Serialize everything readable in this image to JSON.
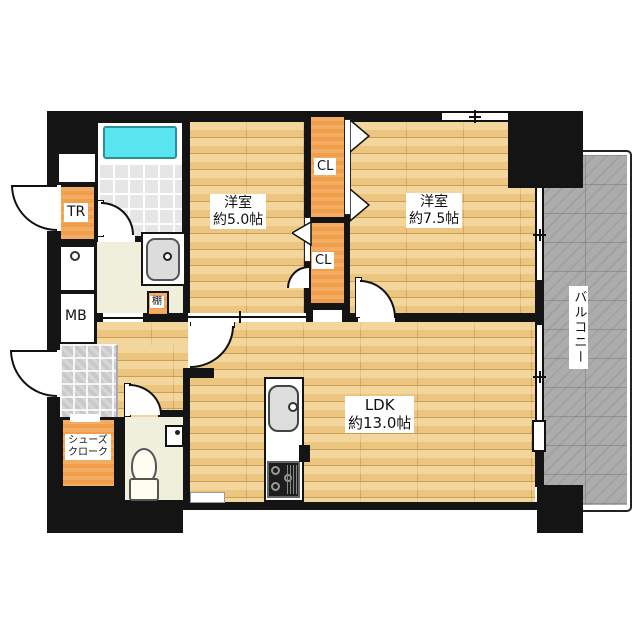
{
  "labels": {
    "bedroom1": {
      "name": "洋室",
      "size": "約5.0帖"
    },
    "bedroom2": {
      "name": "洋室",
      "size": "約7.5帖"
    },
    "ldk": {
      "name": "LDK",
      "size": "約13.0帖"
    },
    "balcony": "バルコニー",
    "closet_upper": "CL",
    "closet_lower": "CL",
    "trunk_room": "TR",
    "meter_box": "MB",
    "shelf": "棚",
    "shoe_closet": {
      "line1": "シューズ",
      "line2": "クローク"
    }
  },
  "colors": {
    "wall": "#141414",
    "wood": "#ecc57e",
    "orange": "#f09e49",
    "cream": "#f0efdb",
    "bath_tile": "#e6e6e6",
    "entry_tile": "#c9c9cb",
    "balcony": "#acacac",
    "bathtub": "#59e5ef"
  }
}
